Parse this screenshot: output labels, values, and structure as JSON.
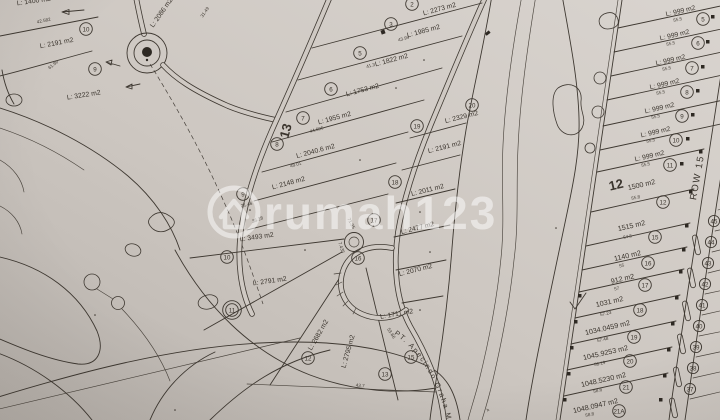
{
  "watermark": {
    "brand": "rumah123",
    "logo": "house-in-circle-icon"
  },
  "road_labels": {
    "row15": "ROW 15"
  },
  "annotations": {
    "company_curved_text": "PT. Apecindo Graha M"
  },
  "block_numbers": {
    "b12": "12",
    "b13": "13"
  },
  "top_left_plots": {
    "cut_area": "L: 1400 m2",
    "p10": {
      "no": "10",
      "area": "L: 2191 m2"
    },
    "p9": {
      "no": "9",
      "area": "L: 3222 m2"
    },
    "p2086": {
      "area": "L: 2086 m2"
    }
  },
  "center_plots": {
    "p2": {
      "no": "2",
      "area": "L: 2273 m2"
    },
    "p3": {
      "no": "3",
      "area": "L: 1985 m2"
    },
    "p5": {
      "no": "5",
      "area": "L: 1822 m2"
    },
    "p6": {
      "no": "6",
      "area": "L: 1753 m2"
    },
    "p7": {
      "no": "7",
      "area": "L: 1955 m2"
    },
    "p8": {
      "no": "8",
      "area": "L: 2040.6 m2"
    },
    "p9": {
      "no": "9",
      "area": "L: 2148 m2"
    },
    "p10": {
      "no": "10",
      "area": "L: 3493 m2"
    },
    "p11": {
      "no": "11",
      "area": "L: 2791 m2"
    },
    "p12": {
      "no": "12",
      "area": "L: 2682 m2"
    },
    "p13": {
      "no": "13",
      "area": "L: 2795 m2"
    },
    "p15": {
      "no": "15",
      "area": "L: 1711 m2"
    },
    "p16": {
      "no": "16",
      "area": "L: 2070 m2"
    },
    "p17": {
      "no": "17",
      "area": "L: 2477 m2"
    },
    "p18": {
      "no": "18",
      "area": "L: 2011 m2"
    },
    "p19": {
      "no": "19",
      "area": "L: 2191 m2"
    },
    "p20": {
      "no": "20",
      "area": "L: 2329 m2"
    }
  },
  "right_column": {
    "rows": [
      {
        "no": "5",
        "area": "L: 999 m2",
        "dim": "55.5"
      },
      {
        "no": "6",
        "area": "L: 999 m2",
        "dim": "55.5"
      },
      {
        "no": "7",
        "area": "L: 999 m2",
        "dim": "55.5"
      },
      {
        "no": "8",
        "area": "L: 999 m2",
        "dim": "55.5"
      },
      {
        "no": "9",
        "area": "L: 999 m2",
        "dim": "55.5"
      },
      {
        "no": "10",
        "area": "L: 999 m2",
        "dim": "55.5"
      },
      {
        "no": "11",
        "area": "L: 999 m2",
        "dim": "55.5"
      },
      {
        "no": "12",
        "area": "1500 m2",
        "dim": "55.8"
      },
      {
        "no": "15",
        "area": "1515 m2",
        "dim": "54.5"
      },
      {
        "no": "16",
        "area": "1140 m2",
        "dim": "55"
      },
      {
        "no": "17",
        "area": "912 m2",
        "dim": "57"
      },
      {
        "no": "18",
        "area": "1031 m2",
        "dim": "57.23"
      },
      {
        "no": "19",
        "area": "1034.0459 m2",
        "dim": "57.48"
      },
      {
        "no": "20",
        "area": "1045.9253 m2",
        "dim": "58.19"
      },
      {
        "no": "21",
        "area": "1048.5230 m2",
        "dim": "58.6"
      },
      {
        "no": "21A",
        "area": "1048.0947 m2",
        "dim": "58.8"
      }
    ]
  },
  "mini_plot_numbers": [
    "45",
    "44",
    "43",
    "42",
    "41",
    "40",
    "39",
    "38",
    "37"
  ],
  "dimensions": {
    "d1": "42.582",
    "d2": "61.99",
    "d3": "31.49",
    "d4": "43.99",
    "d5": "41.3",
    "d6": "44.696",
    "d7": "48.01",
    "d8": "36.28",
    "d9": "21.46",
    "d10": "71.35",
    "d11": "7.435",
    "d12": "43.7",
    "d13": "53.66",
    "d14": "4"
  }
}
